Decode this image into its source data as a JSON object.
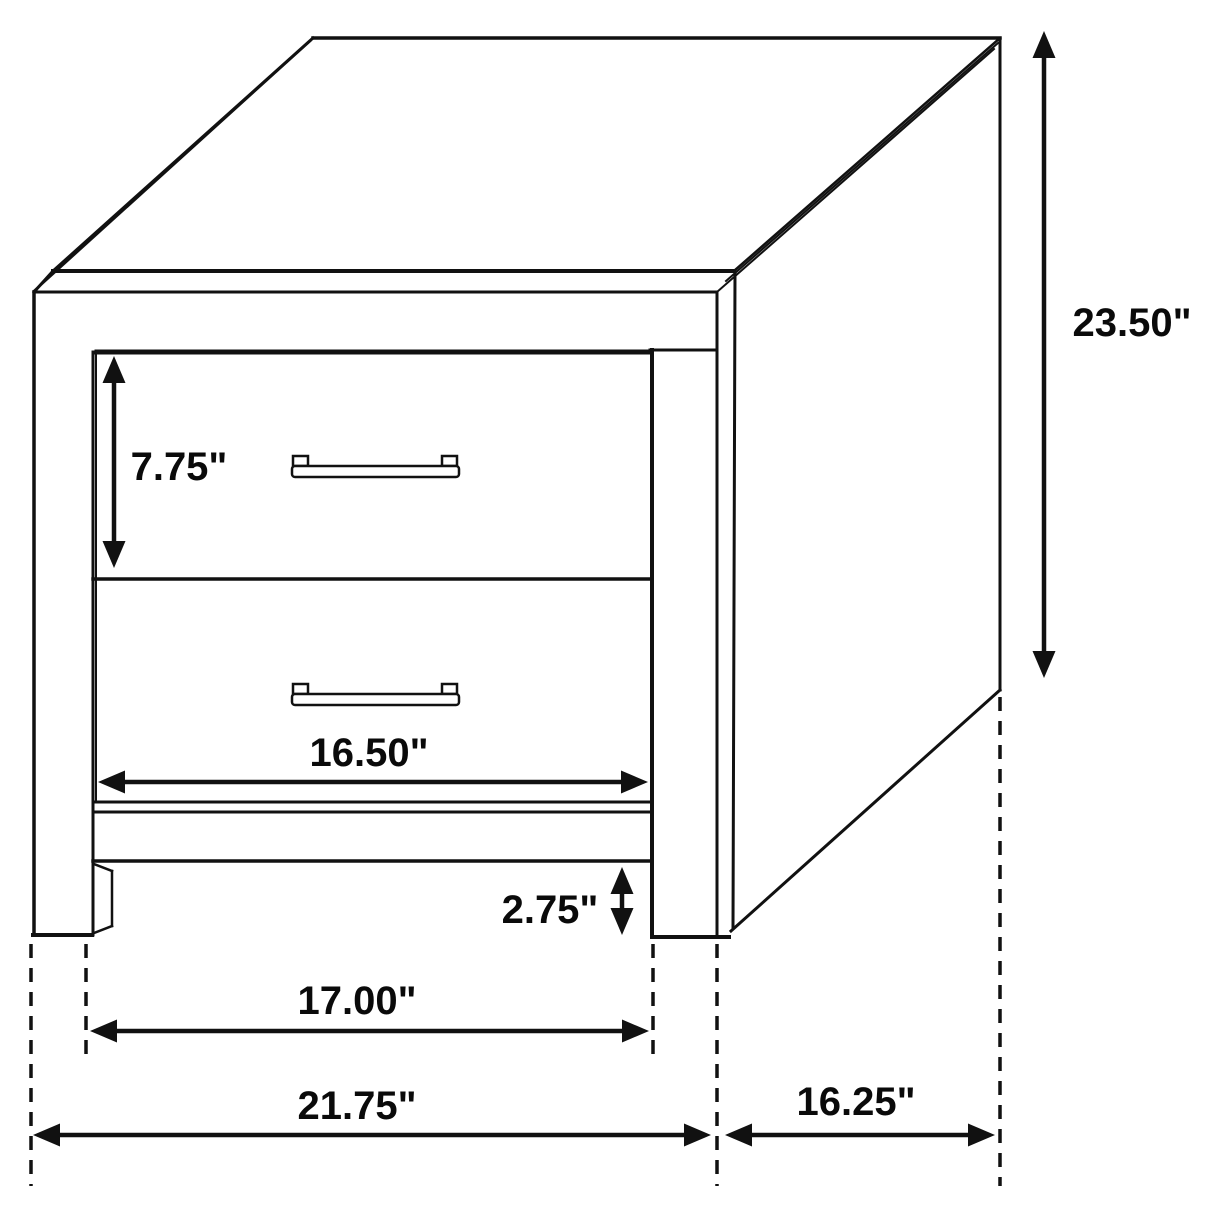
{
  "page": {
    "background": "#ffffff",
    "description": "Technical dimension line drawing of a two-drawer nightstand shown in oblique projection"
  },
  "diagram": {
    "width": 1214,
    "height": 1214,
    "stroke_color": "#111111",
    "shadow_color": "#3c3c3c",
    "label_color": "#0a0a0a",
    "label_font_size": 40,
    "arrow_head_length": 27,
    "arrow_head_half_width": 11.5,
    "dash_pattern": "14 10",
    "dash_width": 3.5,
    "shaft_width": 4.5,
    "labels": [
      {
        "name": "dim-label-drawer-height",
        "text": "7.75\"",
        "x": 179,
        "y": 467
      },
      {
        "name": "dim-label-overall-height",
        "text": "23.50\"",
        "x": 1132,
        "y": 323
      },
      {
        "name": "dim-label-drawer-width",
        "text": "16.50\"",
        "x": 369,
        "y": 753
      },
      {
        "name": "dim-label-base-height",
        "text": "2.75\"",
        "x": 550,
        "y": 910
      },
      {
        "name": "dim-label-leg-span",
        "text": "17.00\"",
        "x": 357,
        "y": 1001
      },
      {
        "name": "dim-label-overall-width",
        "text": "21.75\"",
        "x": 357,
        "y": 1106
      },
      {
        "name": "dim-label-depth",
        "text": "16.25\"",
        "x": 856,
        "y": 1102
      }
    ],
    "arrows": [
      {
        "name": "arrow-drawer-height",
        "x1": 114,
        "y1": 356,
        "x2": 114,
        "y2": 568
      },
      {
        "name": "arrow-overall-height",
        "x1": 1044,
        "y1": 31,
        "x2": 1044,
        "y2": 678
      },
      {
        "name": "arrow-base-height",
        "x1": 622,
        "y1": 867,
        "x2": 622,
        "y2": 935
      },
      {
        "name": "arrow-drawer-width",
        "x1": 98,
        "y1": 782,
        "x2": 648,
        "y2": 782
      },
      {
        "name": "arrow-leg-span",
        "x1": 90,
        "y1": 1031,
        "x2": 649,
        "y2": 1031
      },
      {
        "name": "arrow-overall-width",
        "x1": 33,
        "y1": 1135,
        "x2": 711,
        "y2": 1135
      },
      {
        "name": "arrow-depth",
        "x1": 725,
        "y1": 1135,
        "x2": 995,
        "y2": 1135
      }
    ],
    "dashed_lines": [
      {
        "name": "dash-left-outer-leg",
        "x1": 31,
        "y1": 944,
        "x2": 31,
        "y2": 1186
      },
      {
        "name": "dash-left-inner-leg",
        "x1": 86,
        "y1": 944,
        "x2": 86,
        "y2": 1058
      },
      {
        "name": "dash-right-inner-leg",
        "x1": 653,
        "y1": 944,
        "x2": 653,
        "y2": 1058
      },
      {
        "name": "dash-right-outer-leg",
        "x1": 717,
        "y1": 944,
        "x2": 717,
        "y2": 1186
      },
      {
        "name": "dash-back-edge",
        "x1": 1000,
        "y1": 697,
        "x2": 1000,
        "y2": 1186
      }
    ],
    "outline_lines": [
      {
        "name": "top-band-top-edge",
        "x1": 53,
        "y1": 271,
        "x2": 733,
        "y2": 271,
        "w": 4
      },
      {
        "name": "top-band-bottom-edge",
        "x1": 34,
        "y1": 292,
        "x2": 717,
        "y2": 292,
        "w": 3
      },
      {
        "name": "top-band-left-bevel",
        "x1": 34,
        "y1": 292,
        "x2": 53,
        "y2": 271,
        "w": 3
      },
      {
        "name": "top-back-edge",
        "x1": 313,
        "y1": 38,
        "x2": 1000,
        "y2": 38,
        "w": 3.5
      },
      {
        "name": "top-left-edge-outer",
        "x1": 34,
        "y1": 291,
        "x2": 310,
        "y2": 41,
        "w": 2.5
      },
      {
        "name": "top-left-edge-inner",
        "x1": 53,
        "y1": 271,
        "x2": 313,
        "y2": 38,
        "w": 3
      },
      {
        "name": "top-right-edge-line1",
        "x1": 734,
        "y1": 271,
        "x2": 1000,
        "y2": 38,
        "w": 2.5
      },
      {
        "name": "top-right-edge-line2",
        "x1": 726,
        "y1": 281,
        "x2": 998,
        "y2": 43,
        "w": 2
      },
      {
        "name": "top-right-edge-line3",
        "x1": 717,
        "y1": 292,
        "x2": 994,
        "y2": 49,
        "w": 2
      },
      {
        "name": "side-right-back-edge",
        "x1": 1000,
        "y1": 38,
        "x2": 1000,
        "y2": 690,
        "w": 3
      },
      {
        "name": "side-bottom-edge",
        "x1": 1000,
        "y1": 690,
        "x2": 731,
        "y2": 931,
        "w": 3
      },
      {
        "name": "side-front-edge",
        "x1": 735,
        "y1": 272,
        "x2": 733,
        "y2": 928,
        "w": 3
      },
      {
        "name": "front-right-outer-edge",
        "x1": 717,
        "y1": 292,
        "x2": 717,
        "y2": 936,
        "w": 3
      },
      {
        "name": "front-left-outer-edge",
        "x1": 34,
        "y1": 292,
        "x2": 34,
        "y2": 935,
        "w": 3.5
      },
      {
        "name": "left-leg-bottom-edge",
        "x1": 33,
        "y1": 935,
        "x2": 92,
        "y2": 935,
        "w": 4
      },
      {
        "name": "top-rail-right-segment",
        "x1": 650,
        "y1": 350,
        "x2": 717,
        "y2": 350,
        "w": 3
      },
      {
        "name": "drawer-opening-top-edge",
        "x1": 97,
        "y1": 352,
        "x2": 650,
        "y2": 352,
        "w": 5
      },
      {
        "name": "left-stile-inner-edge",
        "x1": 93,
        "y1": 352,
        "x2": 93,
        "y2": 935,
        "w": 3
      },
      {
        "name": "drawer-divider-edge",
        "x1": 93,
        "y1": 579,
        "x2": 652,
        "y2": 579,
        "w": 3.5
      },
      {
        "name": "drawer2-bottom-edge",
        "x1": 95,
        "y1": 802,
        "x2": 650,
        "y2": 802,
        "w": 3
      },
      {
        "name": "bottom-rail-top-edge",
        "x1": 93,
        "y1": 812,
        "x2": 652,
        "y2": 812,
        "w": 3
      },
      {
        "name": "bottom-rail-bottom-edge",
        "x1": 93,
        "y1": 861,
        "x2": 652,
        "y2": 861,
        "w": 3.5
      },
      {
        "name": "right-stile-inner-edge",
        "x1": 652,
        "y1": 350,
        "x2": 652,
        "y2": 936,
        "w": 4
      },
      {
        "name": "right-leg-floor-edge",
        "x1": 652,
        "y1": 937,
        "x2": 729,
        "y2": 937,
        "w": 4
      },
      {
        "name": "left-leg-depth-top",
        "x1": 94,
        "y1": 864,
        "x2": 112,
        "y2": 871,
        "w": 2.5
      },
      {
        "name": "left-leg-depth-back",
        "x1": 112,
        "y1": 871,
        "x2": 112,
        "y2": 926,
        "w": 2.5
      },
      {
        "name": "left-leg-depth-foot",
        "x1": 94,
        "y1": 933,
        "x2": 112,
        "y2": 926,
        "w": 2.5
      },
      {
        "name": "drawer1-left-edge",
        "x1": 96,
        "y1": 353,
        "x2": 96,
        "y2": 577,
        "w": 2
      },
      {
        "name": "drawer2-left-edge",
        "x1": 96,
        "y1": 581,
        "x2": 96,
        "y2": 801,
        "w": 2
      }
    ],
    "handles": [
      {
        "name": "drawer1-handle",
        "x": 292,
        "y": 456
      },
      {
        "name": "drawer2-handle",
        "x": 292,
        "y": 684
      }
    ],
    "handle_geometry": {
      "bar_width": 167,
      "bar_height": 11,
      "bar_offset_y": 10,
      "bar_radius": 3,
      "tab_width": 15,
      "tab_height": 10,
      "tab_left_offset": 1,
      "tab_right_offset": 150,
      "stroke_width": 2.5
    }
  }
}
